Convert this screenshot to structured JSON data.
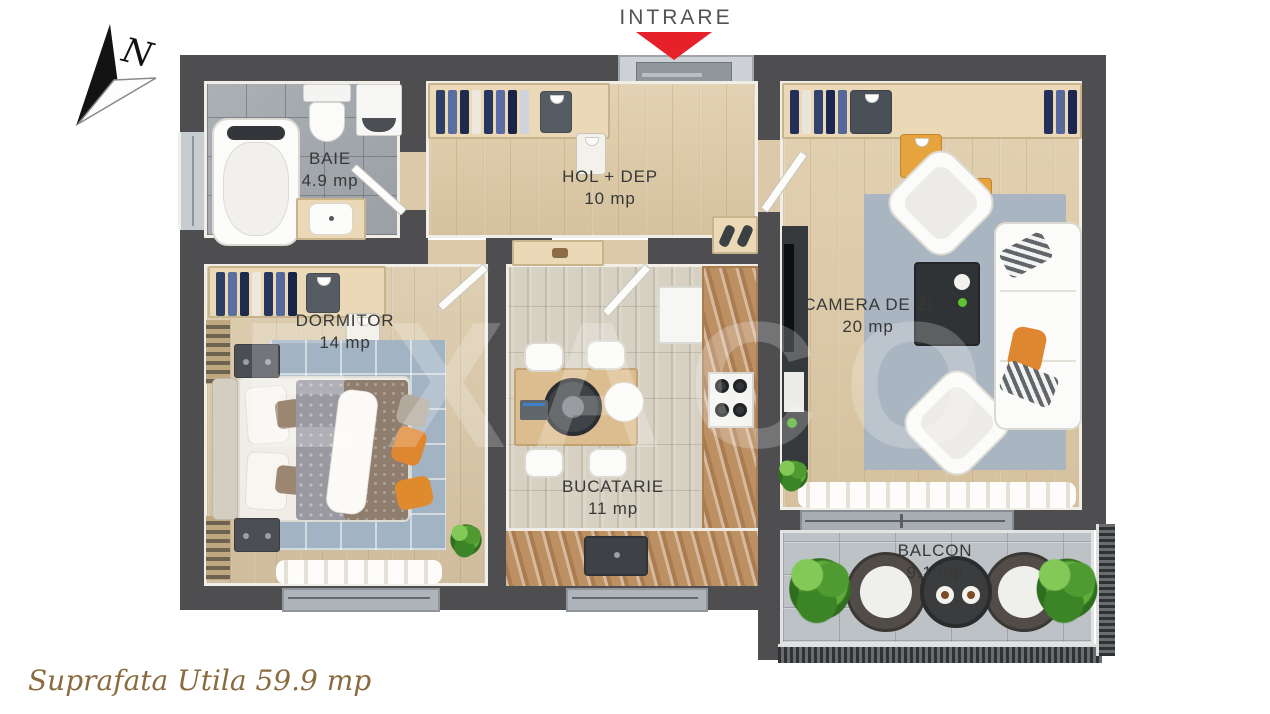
{
  "compass": {
    "label": "N"
  },
  "entrance": {
    "label": "INTRARE",
    "arrow_color": "#e62129"
  },
  "rooms": {
    "baie": {
      "name": "BAIE",
      "area": "4.9 mp"
    },
    "hol": {
      "name": "HOL + DEP",
      "area": "10 mp"
    },
    "dormitor": {
      "name": "DORMITOR",
      "area": "14 mp"
    },
    "bucatarie": {
      "name": "BUCATARIE",
      "area": "11 mp"
    },
    "camera_de_zi": {
      "name": "CAMERA DE ZI",
      "area": "20 mp"
    },
    "balcon": {
      "name": "BALCON",
      "area": "9.1 mp"
    }
  },
  "footer": {
    "total_label": "Suprafata Utila 59.9 mp"
  },
  "watermark": {
    "text": "EXACO"
  },
  "colors": {
    "wall": "#4e4e50",
    "wood_floor": "#ddcaa9",
    "bath_tile": "#a3a9ad",
    "kitchen_floor": "#d6d1c3",
    "balcony_tile": "#bcc2c6",
    "counter_marble": "#bd9064",
    "rug": "#a9b5c1",
    "accent_orange": "#df8630",
    "arrow_red": "#e62129",
    "footer_gold": "#8a6b3f"
  }
}
